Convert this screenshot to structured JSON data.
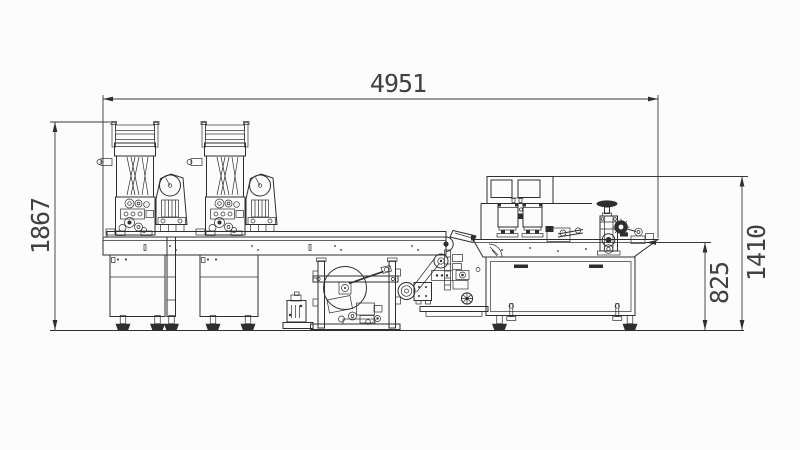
{
  "drawing": {
    "background": "#fcfcfc",
    "line_color": "#2e2e2e",
    "dimensions": {
      "overall_length": "4951",
      "overall_height": "1867",
      "machine_height": "1410",
      "table_height": "825"
    }
  }
}
